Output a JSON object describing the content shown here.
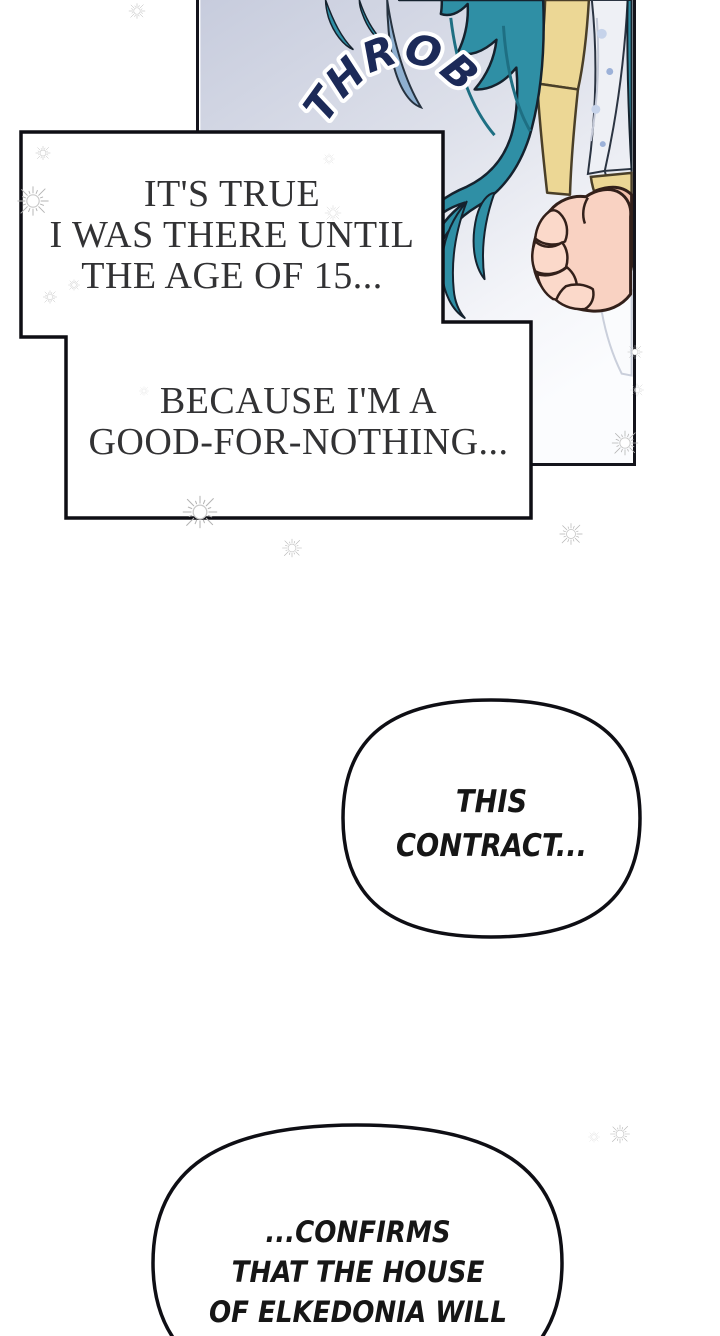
{
  "sfx": {
    "throb": "THROB"
  },
  "narration": {
    "box_top_lines": [
      "IT'S TRUE",
      "I WAS THERE UNTIL",
      "THE AGE OF 15..."
    ],
    "box_bottom_lines": [
      "BECAUSE I'M A",
      "GOOD-FOR-NOTHING..."
    ]
  },
  "bubbles": {
    "contract_lines": [
      "THIS",
      "CONTRACT..."
    ],
    "confirms_lines": [
      "...CONFIRMS",
      "THAT THE HOUSE",
      "OF ELKEDONIA WILL"
    ]
  },
  "colors": {
    "hair": "#2f8fa5",
    "hair_outline": "#15222e",
    "hair_accent": "#8fb0d0",
    "ribbon": "#ecd795",
    "skin": "#f9d2c2",
    "skin_shadow": "#eeb49e",
    "sfx_fill": "#1c2a58",
    "panel_bg_top": "#c7ccdd",
    "panel_bg_bottom": "#fbfcfe",
    "line": "#14141c",
    "text": "#323234"
  }
}
